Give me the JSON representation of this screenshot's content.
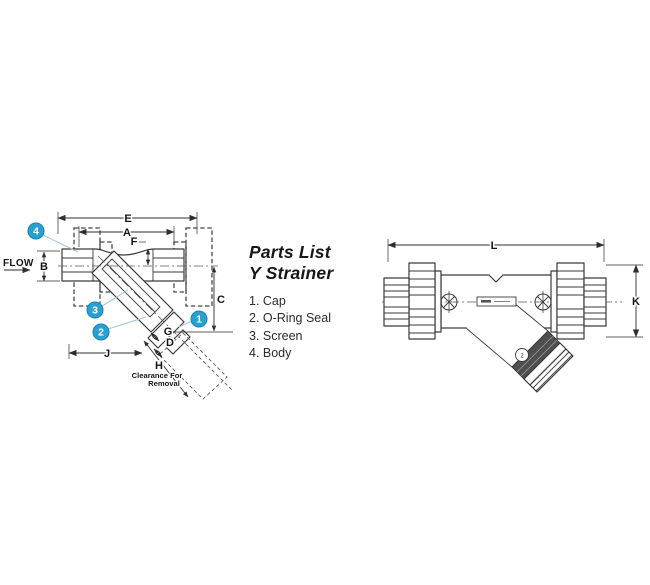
{
  "figure": {
    "parts_list": {
      "title_line1": "Parts List",
      "title_line2": "Y Strainer",
      "items": [
        "1. Cap",
        "2. O-Ring Seal",
        "3. Screen",
        "4. Body"
      ]
    },
    "left_view": {
      "flow_label": "FLOW",
      "dim_e": "E",
      "dim_a": "A",
      "dim_f": "F",
      "dim_b": "B",
      "dim_c": "C",
      "dim_g": "G",
      "dim_d": "D",
      "dim_j": "J",
      "dim_h": "H",
      "clearance_line1": "Clearance For",
      "clearance_line2": "Removal",
      "callout_1": "1",
      "callout_2": "2",
      "callout_3": "3",
      "callout_4": "4"
    },
    "right_view": {
      "dim_l": "L",
      "dim_k": "K",
      "size_mark": "2"
    },
    "colors": {
      "line": "#3a3a3a",
      "callout_fill": "#29a0d2",
      "callout_stroke": "#1583b3",
      "callout_text": "#ffffff",
      "leader": "#a3c8d8",
      "cap_band": "#4f4f4f",
      "background": "#ffffff"
    }
  }
}
